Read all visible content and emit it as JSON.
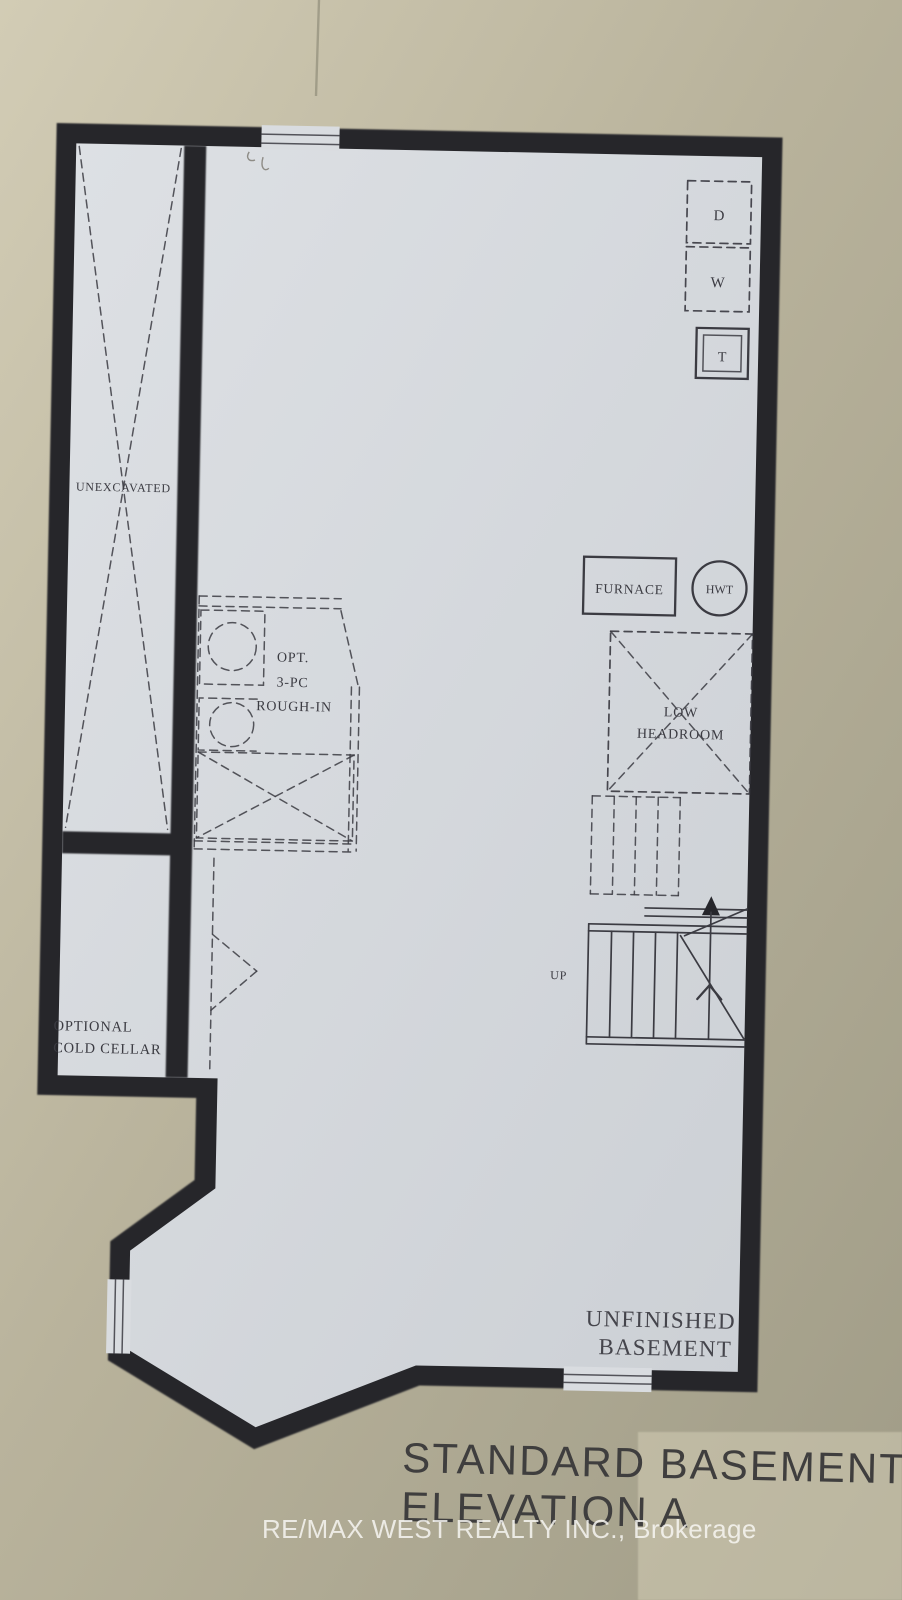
{
  "title_block": {
    "line1": "STANDARD BASEMENT",
    "line2": "ELEVATION A"
  },
  "watermark": {
    "text": "RE/MAX WEST REALTY INC., Brokerage"
  },
  "plan": {
    "rooms": {
      "unexcavated": "UNEXCAVATED",
      "cold_cellar": [
        "OPTIONAL",
        "COLD CELLAR"
      ],
      "unfinished_basement": [
        "UNFINISHED",
        "BASEMENT"
      ],
      "low_headroom": [
        "LOW",
        "HEADROOM"
      ],
      "rough_in": [
        "OPT.",
        "3-PC",
        "ROUGH-IN"
      ]
    },
    "fixtures": {
      "dryer": "D",
      "washer": "W",
      "laundry_tub": "T",
      "furnace": "FURNACE",
      "hot_water_tank": "HWT",
      "stair_direction": "UP"
    },
    "colors": {
      "wall": "#26262b",
      "paper": "#d7dade",
      "ink": "#3b3b42",
      "bg-light": "#d1cbb4",
      "bg-mid": "#b9b39c",
      "bg-dark": "#a19d88",
      "title": "#3f3e3e",
      "watermark": "#faf9f6"
    }
  }
}
